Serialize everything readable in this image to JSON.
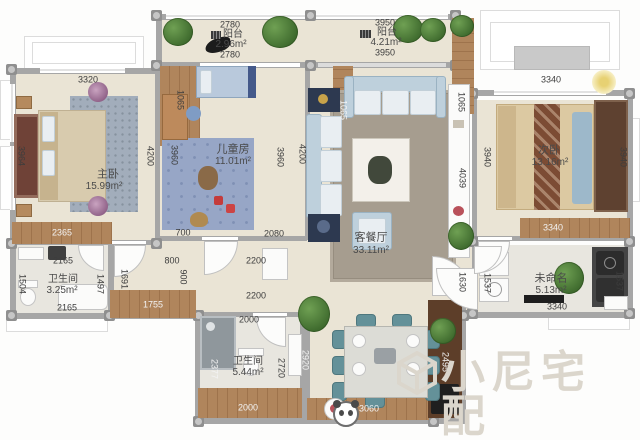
{
  "brand": {
    "watermark": "小尼宅配"
  },
  "rooms": {
    "balcony1": {
      "name": "阳台",
      "area": "2.96m²",
      "dim_top": "2780",
      "dim_bottom": "2780",
      "dim_side": "1065"
    },
    "balcony2": {
      "name": "阳台",
      "area": "4.21m²",
      "dim_top": "3950",
      "dim_bottom": "3950",
      "dim_side_left": "1065",
      "dim_side_right": "1065"
    },
    "master": {
      "name": "主卧",
      "area": "15.99m²",
      "dim_top": "3320",
      "dim_left": "3964",
      "dim_right": "4200",
      "dim_bottom": "2365"
    },
    "kids": {
      "name": "儿童房",
      "area": "11.01m²",
      "dim_left": "3960",
      "dim_right": "3960",
      "dim_bottom_left": "700",
      "dim_bottom_right": "2080"
    },
    "living": {
      "name": "客餐厅",
      "area": "33.11m²",
      "dim_left": "4200",
      "dim_right": "4039"
    },
    "second": {
      "name": "次卧",
      "area": "13.16m²",
      "dim_top": "3340",
      "dim_left": "3940",
      "dim_right": "3940",
      "dim_bottom": "3340"
    },
    "bath1": {
      "name": "卫生间",
      "area": "3.25m²",
      "dim_top": "2165",
      "dim_left": "1504",
      "dim_right": "1497",
      "dim_bottom": "2165"
    },
    "bath2": {
      "name": "卫生间",
      "area": "5.44m²",
      "dim_top": "2000",
      "dim_left": "2377",
      "dim_right": "2720",
      "dim_bottom": "2000"
    },
    "unnamed": {
      "name": "未命名",
      "area": "5.13m²",
      "dim_left": "1537",
      "dim_right": "1537",
      "dim_outer": "1630",
      "dim_bottom": "3340"
    }
  },
  "hall": {
    "dim_800": "800",
    "dim_900": "900",
    "dim_1691": "1691",
    "dim_1755": "1755",
    "dim_2200a": "2200",
    "dim_2200b": "2200"
  },
  "dining": {
    "dim_left": "2920",
    "dim_bottom": "3060",
    "dim_right": "2495"
  }
}
